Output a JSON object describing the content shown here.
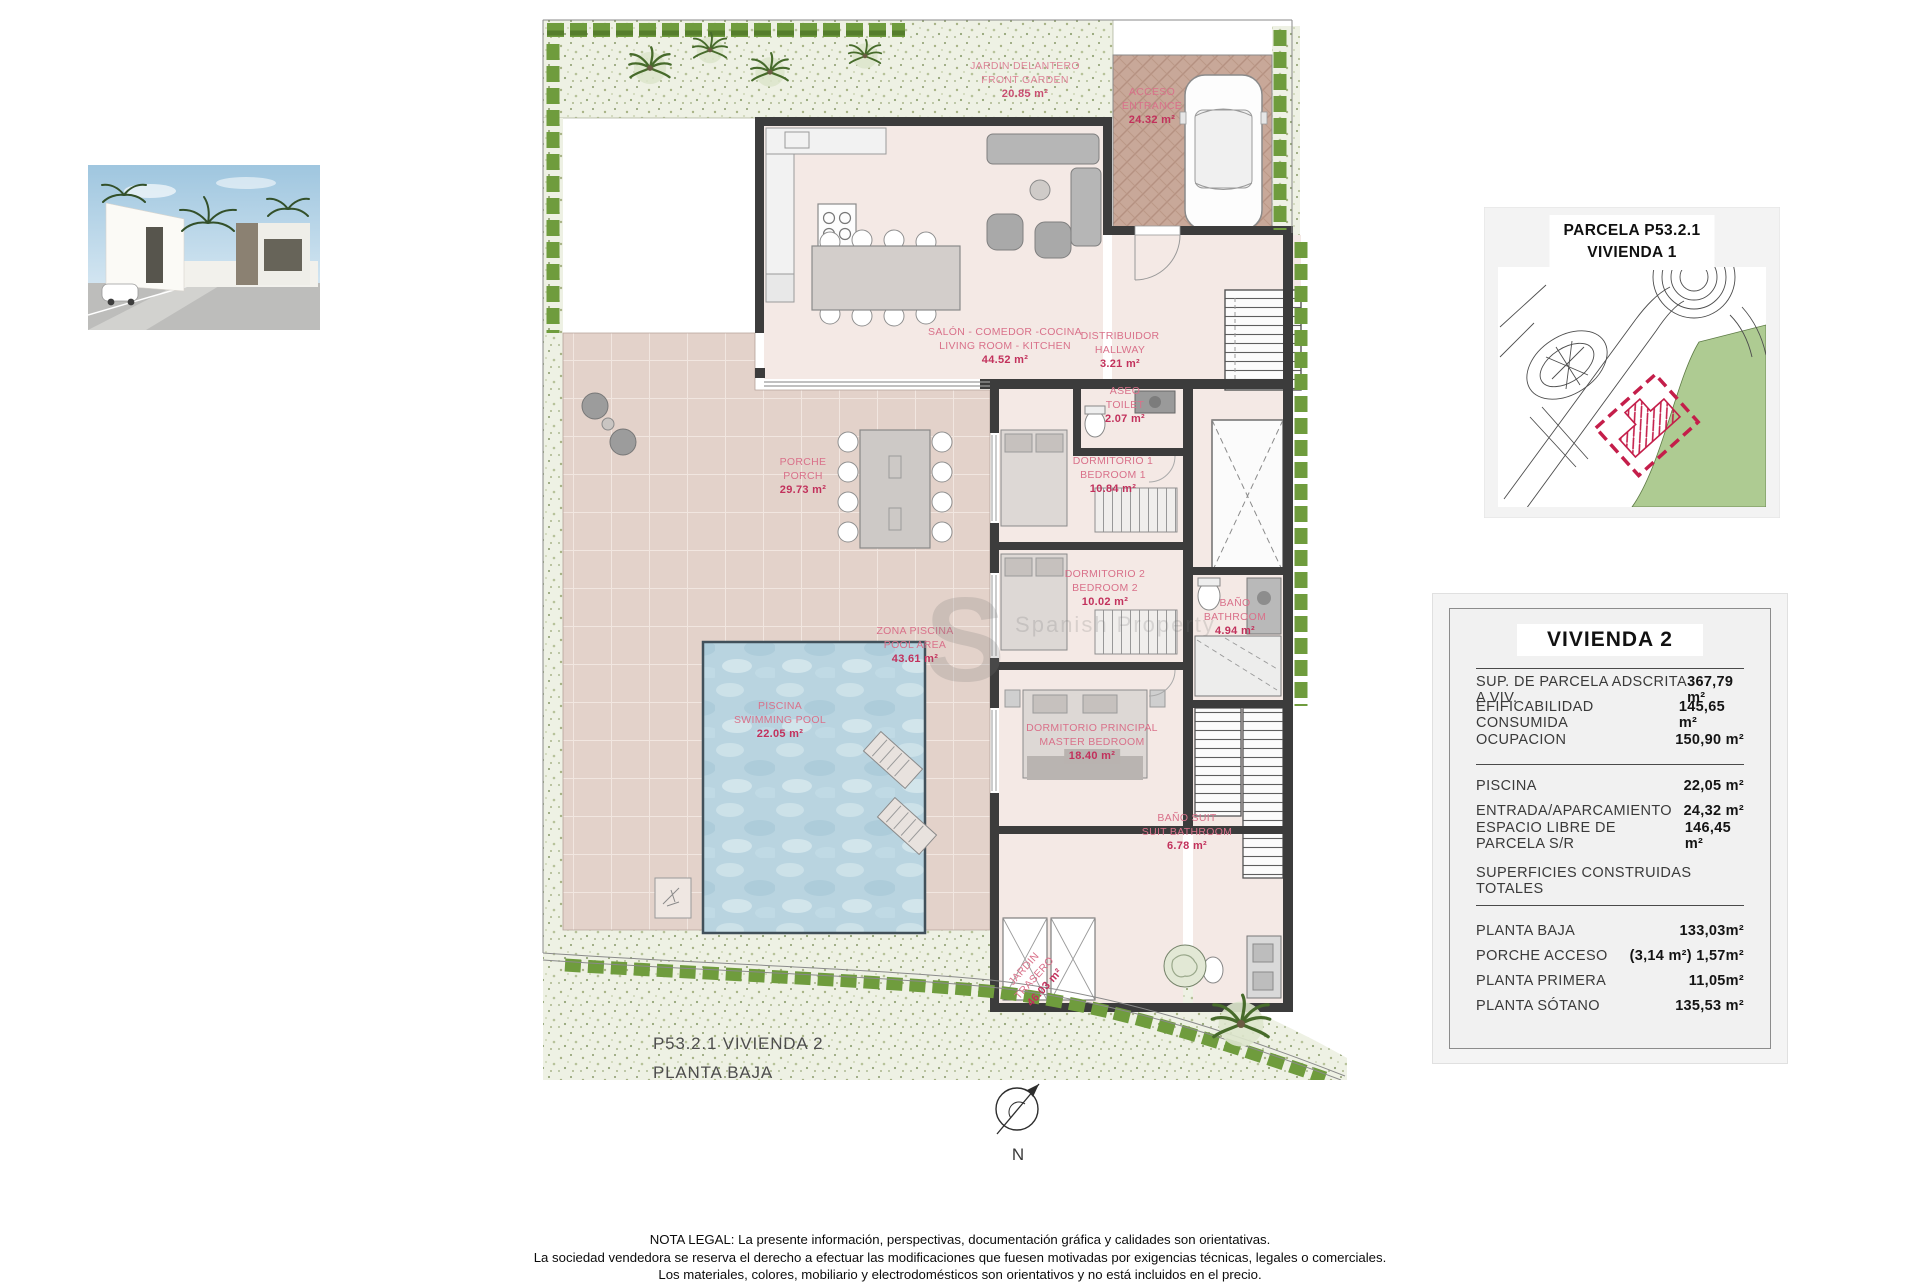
{
  "page": {
    "caption_line1": "P53.2.1 VIVIENDA 2",
    "caption_line2": "PLANTA BAJA",
    "north_label": "N",
    "watermark_letter": "S",
    "watermark_text": "Spanish Property"
  },
  "map_panel": {
    "title_line1": "PARCELA P53.2.1",
    "title_line2": "VIVIENDA 1"
  },
  "summary_table": {
    "title": "VIVIENDA 2",
    "rows_parcel": [
      {
        "label": "SUP. DE PARCELA ADSCRITA A VIV.",
        "value": "367,79 m²"
      },
      {
        "label": "EFIFICABILIDAD CONSUMIDA",
        "value": "145,65 m²"
      },
      {
        "label": "OCUPACION",
        "value": "150,90 m²"
      }
    ],
    "rows_exterior": [
      {
        "label": "PISCINA",
        "value": "22,05 m²"
      },
      {
        "label": "ENTRADA/APARCAMIENTO",
        "value": "24,32 m²"
      },
      {
        "label": "ESPACIO LIBRE DE PARCELA S/R",
        "value": "146,45 m²"
      }
    ],
    "section_header": "SUPERFICIES CONSTRUIDAS TOTALES",
    "rows_built": [
      {
        "label": "PLANTA BAJA",
        "value": "133,03m²"
      },
      {
        "label": "PORCHE ACCESO",
        "value": "(3,14 m²) 1,57m²"
      },
      {
        "label": "PLANTA PRIMERA",
        "value": "11,05m²"
      },
      {
        "label": "PLANTA SÓTANO",
        "value": "135,53 m²"
      }
    ]
  },
  "plan": {
    "labels": [
      {
        "line1": "ACCESO",
        "line2": "ENTRANCE",
        "area": "24.32 m²"
      },
      {
        "line1": "JARDIN DELANTERO",
        "line2": "FRONT GARDEN",
        "area": "20.85 m²"
      },
      {
        "line1": "SALÓN - COMEDOR -COCINA",
        "line2": "LIVING ROOM - KITCHEN",
        "area": "44.52 m²"
      },
      {
        "line1": "DISTRIBUIDOR",
        "line2": "HALLWAY",
        "area": "3.21 m²"
      },
      {
        "line1": "ASEO",
        "line2": "TOILET",
        "area": "2.07 m²"
      },
      {
        "line1": "DORMITORIO 1",
        "line2": "BEDROOM 1",
        "area": "10.84 m²"
      },
      {
        "line1": "DORMITORIO 2",
        "line2": "BEDROOM 2",
        "area": "10.02 m²"
      },
      {
        "line1": "BAÑO",
        "line2": "BATHROOM",
        "area": "4.94 m²"
      },
      {
        "line1": "DORMITORIO PRINCIPAL",
        "line2": "MASTER BEDROOM",
        "area": "18.40 m²"
      },
      {
        "line1": "BAÑO SUIT",
        "line2": "SUIT BATHROOM",
        "area": "6.78 m²"
      },
      {
        "line1": "PORCHE",
        "line2": "PORCH",
        "area": "29.73 m²"
      },
      {
        "line1": "ZONA PISCINA",
        "line2": "POOL AREA",
        "area": "43.61 m²"
      },
      {
        "line1": "PISCINA",
        "line2": "SWIMMING POOL",
        "area": "22.05 m²"
      },
      {
        "line1": "JARDIN",
        "line2": "TRASERO",
        "area": "46.03 m²"
      }
    ]
  },
  "legal": {
    "line1": "NOTA LEGAL: La presente información, perspectivas, documentación gráfica y calidades son orientativas.",
    "line2": "La sociedad vendedora se reserva el derecho a efectuar las modificaciones que fuesen motivadas por exigencias técnicas, legales o comerciales.",
    "line3": "Los materiales, colores, mobiliario y electrodomésticos son orientativos y no está incluidos en el precio."
  }
}
